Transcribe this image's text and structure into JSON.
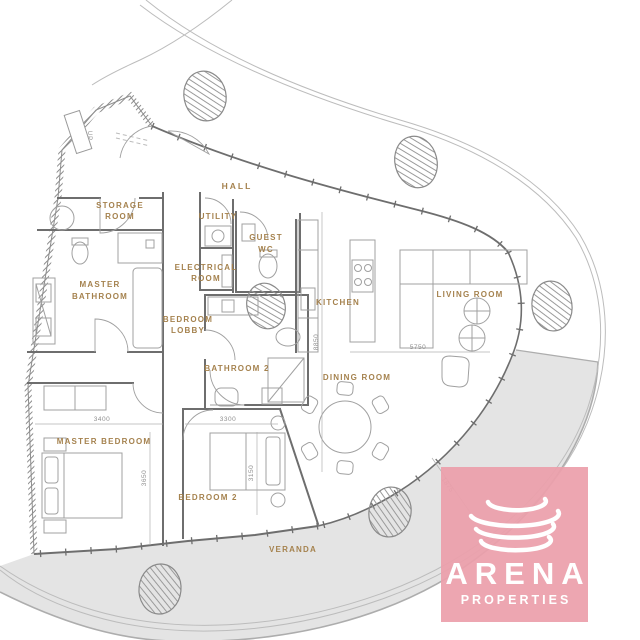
{
  "plan": {
    "type": "apartment-floor-plan",
    "labels": {
      "hall": "HALL",
      "storage_1": "STORAGE",
      "storage_2": "ROOM",
      "utility": "UTILITY",
      "guest_wc_1": "GUEST",
      "guest_wc_2": "WC",
      "electrical_1": "ELECTRICAL",
      "electrical_2": "ROOM",
      "master_bath_1": "MASTER",
      "master_bath_2": "BATHROOM",
      "bedroom_lobby_1": "BEDROOM",
      "bedroom_lobby_2": "LOBBY",
      "kitchen": "KITCHEN",
      "living_room": "LIVING ROOM",
      "bathroom2": "BATHROOM 2",
      "dining_room": "DINING ROOM",
      "master_bedroom": "MASTER BEDROOM",
      "bedroom2": "BEDROOM 2",
      "veranda": "VERANDA",
      "stairs": "UP"
    },
    "dimensions": {
      "master_bedroom_width": "3400",
      "master_bedroom_depth": "3650",
      "bedroom2_width": "3300",
      "bedroom2_depth": "3150",
      "living_width": "5750",
      "interior_depth": "8850",
      "veranda_width": "1875"
    },
    "colors": {
      "label": "#a5824e",
      "walls": "#6e6e6e",
      "furniture": "#a0a0a0",
      "veranda_fill": "#e4e4e4",
      "watermark_pink": "#ec9fab",
      "dimension_text": "#8f8f8f"
    }
  },
  "watermark": {
    "brand": "ARENA",
    "tagline": "PROPERTIES"
  }
}
